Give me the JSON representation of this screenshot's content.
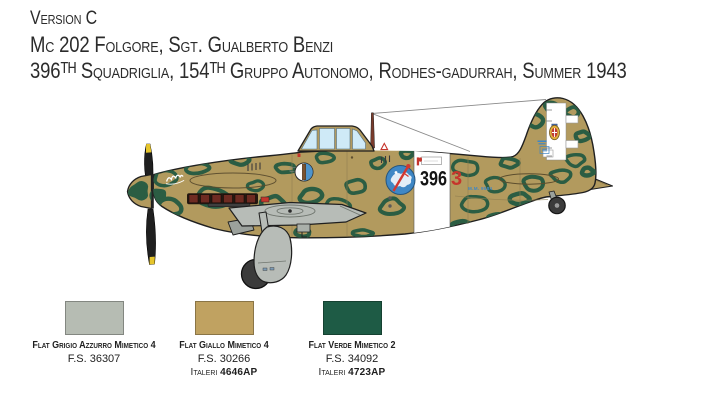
{
  "header": {
    "version_line": "Version C",
    "aircraft_line": "Mc 202 Folgore, Sgt. Gualberto Benzi",
    "unit_line": "396ᵀᴴ Squadriglia, 154ᵀᴴ Gruppo Autonomo, Rodhes-gadurrah, Summer 1943"
  },
  "markings": {
    "squadron_number": "396",
    "aircraft_number": "3",
    "serial_number": "M.M. 9584"
  },
  "icons": {
    "unit_badge": "blue-disc-with-red-sword",
    "nose_emblem": "palm-tree-disc",
    "rudder_shield": "crowned-savoy-shield",
    "band_stencil": "fascio-stencil",
    "nose_art": "white-script-signature",
    "fin_logo": "macchi-blue-logo"
  },
  "palette": [
    {
      "name": "Flat Grigio Azzurro Mimetico 4",
      "fs": "F.S. 36307",
      "italeri_label": "",
      "italeri_code": "",
      "color": "#b6bcb3"
    },
    {
      "name": "Flat Giallo Mimetico 4",
      "fs": "F.S. 30266",
      "italeri_label": "Italeri ",
      "italeri_code": "4646AP",
      "color": "#c0a261"
    },
    {
      "name": "Flat Verde Mimetico 2",
      "fs": "F.S. 34092",
      "italeri_label": "Italeri ",
      "italeri_code": "4723AP",
      "color": "#1e5b45"
    }
  ],
  "artwork": {
    "colors": {
      "tan": "#b29a5e",
      "camo": "#2b5d43",
      "outline": "#1f1f1f",
      "gray": "#b7bcb7",
      "glass": "#cfeaf7",
      "red": "#c5352c",
      "blue": "#3f87c5",
      "yellow": "#e6c52c",
      "exhaust": "#6e2b22",
      "mast": "#7a3b2b",
      "wheel": "#3b3b3b"
    },
    "camo_blobs": [
      [
        139,
        191,
        9,
        8,
        1
      ],
      [
        158,
        196,
        7,
        6,
        1
      ],
      [
        164,
        179,
        12,
        8,
        0
      ],
      [
        171,
        207,
        12,
        8,
        0
      ],
      [
        196,
        168,
        13,
        6,
        0
      ],
      [
        214,
        197,
        15,
        10,
        0
      ],
      [
        240,
        160,
        12,
        5,
        0
      ],
      [
        256,
        186,
        8,
        5,
        0
      ],
      [
        274,
        204,
        12,
        8,
        0
      ],
      [
        286,
        168,
        10,
        5,
        0
      ],
      [
        310,
        196,
        11,
        7,
        0
      ],
      [
        326,
        158,
        11,
        5,
        0
      ],
      [
        336,
        206,
        13,
        8,
        0
      ],
      [
        357,
        186,
        11,
        8,
        0
      ],
      [
        378,
        163,
        8,
        5,
        0
      ],
      [
        392,
        207,
        13,
        8,
        0
      ],
      [
        407,
        154,
        7,
        4,
        0
      ],
      [
        466,
        168,
        12,
        8,
        0
      ],
      [
        474,
        203,
        14,
        8,
        0
      ],
      [
        495,
        184,
        10,
        7,
        0
      ],
      [
        509,
        163,
        9,
        5,
        0
      ],
      [
        521,
        199,
        10,
        6,
        0
      ],
      [
        534,
        183,
        10,
        7,
        0
      ],
      [
        534,
        120,
        10,
        8,
        0
      ],
      [
        552,
        107,
        8,
        5,
        0
      ],
      [
        572,
        112,
        7,
        5,
        0
      ],
      [
        583,
        136,
        7,
        6,
        0
      ],
      [
        575,
        160,
        10,
        7,
        0
      ],
      [
        561,
        176,
        11,
        6,
        0
      ],
      [
        588,
        172,
        6,
        4,
        0
      ],
      [
        302,
        233,
        9,
        4,
        0
      ],
      [
        362,
        233,
        11,
        4,
        0
      ],
      [
        462,
        226,
        10,
        5,
        0
      ],
      [
        497,
        218,
        9,
        4,
        0
      ]
    ]
  }
}
